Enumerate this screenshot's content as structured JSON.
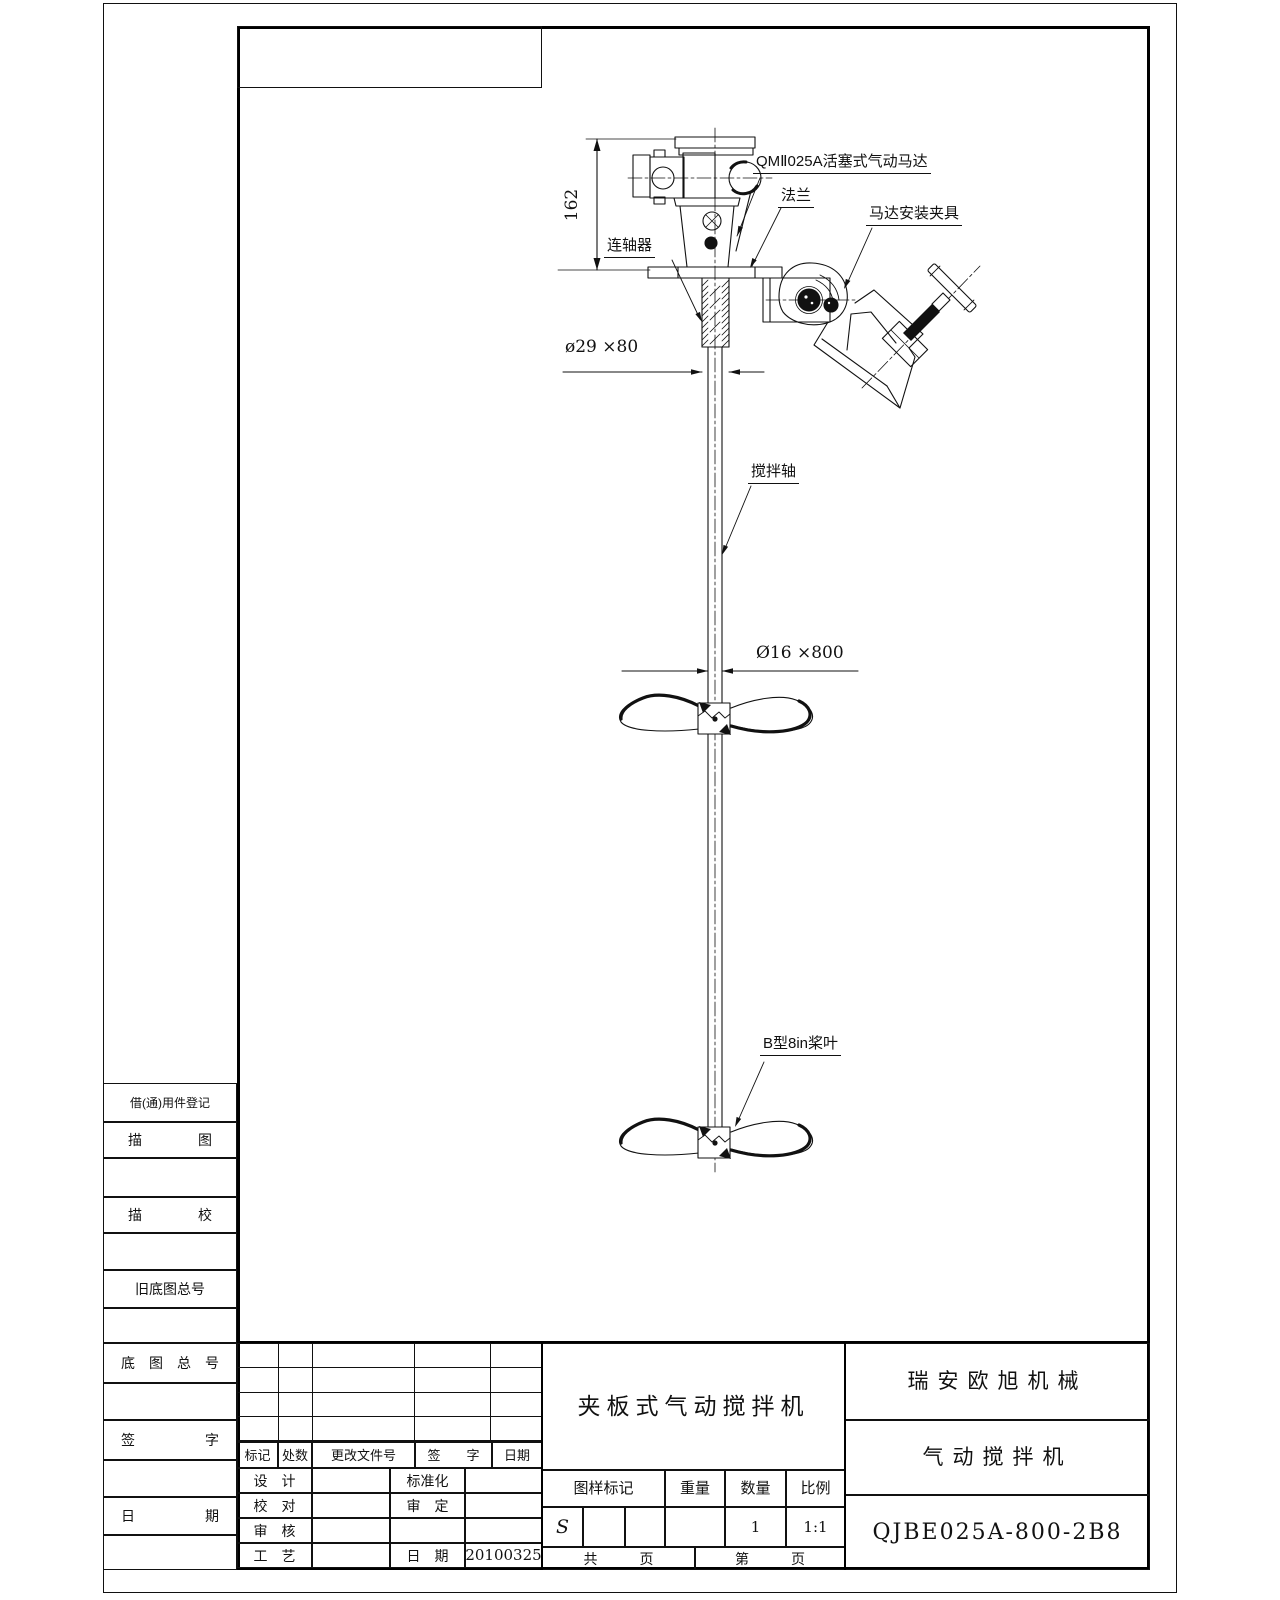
{
  "dw": {
    "motor": "QMⅡ025A活塞式气动马达",
    "flange": "法兰",
    "clamp": "马达安装夹具",
    "coupling": "连轴器",
    "shaft": "搅拌轴",
    "blade": "B型8in桨叶",
    "d162": "162",
    "d29": "ø29 ×80",
    "d16": "Ø16 ×800"
  },
  "sidebar": {
    "rows": [
      "借(通)用件登记",
      "描　　　　图",
      "",
      "描　　　　校",
      "",
      "旧底图总号",
      "",
      "底　图　总　号",
      "",
      "签　　　　　字",
      "",
      "日　　　　　期",
      ""
    ]
  },
  "tb": {
    "rev_header": [
      "标记",
      "处数",
      "更改文件号",
      "签　　字",
      "日期"
    ],
    "sign": [
      [
        "设　计",
        "",
        "标准化",
        ""
      ],
      [
        "校　对",
        "",
        "审　定",
        ""
      ],
      [
        "审　核",
        "",
        "",
        ""
      ],
      [
        "工　艺",
        "",
        "日　期",
        "20100325"
      ]
    ],
    "title": "夹板式气动搅拌机",
    "company": "瑞安欧旭机械",
    "product": "气动搅拌机",
    "dwg_no": "QJBE025A-800-2B8",
    "mark_header": [
      "图样标记",
      "重量",
      "数量",
      "比例"
    ],
    "stamp": "S",
    "qty": "1",
    "scale": "1:1",
    "pages_left": "共　　　页",
    "pages_right": "第　　　页"
  }
}
